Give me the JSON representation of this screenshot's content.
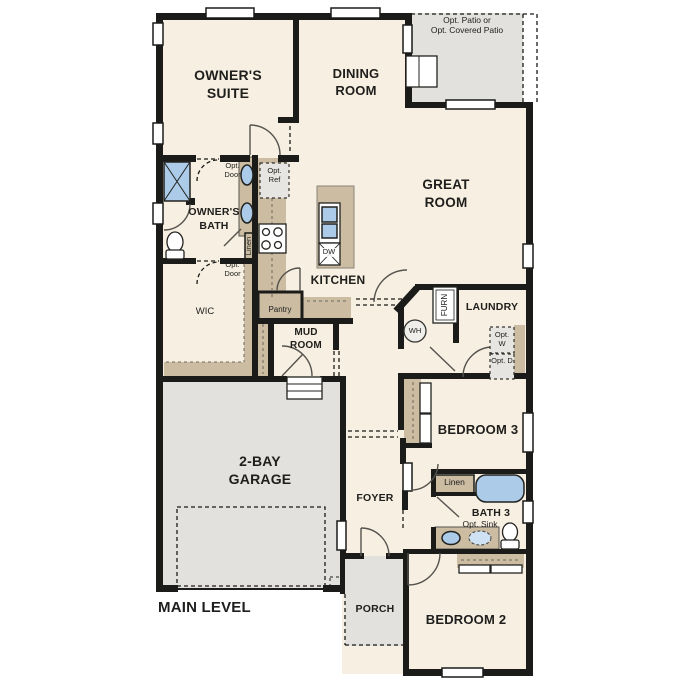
{
  "plan": {
    "title": "MAIN LEVEL",
    "rooms": {
      "owners_suite": "OWNER'S SUITE",
      "dining_room": "DINING ROOM",
      "great_room": "GREAT ROOM",
      "owners_bath": "OWNER'S BATH",
      "wic": "WIC",
      "kitchen": "KITCHEN",
      "pantry": "Pantry",
      "mud_room": "MUD ROOM",
      "laundry": "LAUNDRY",
      "garage": "2-BAY GARAGE",
      "foyer": "FOYER",
      "porch": "PORCH",
      "bedroom3": "BEDROOM 3",
      "bath3": "BATH 3",
      "bedroom2": "BEDROOM 2"
    },
    "annotations": {
      "patio_line1": "Opt. Patio or",
      "patio_line2": "Opt. Covered Patio",
      "opt_door": "Opt. Door",
      "opt_ref": "Opt. Ref",
      "opt_w": "Opt. W",
      "opt_d": "Opt. D",
      "opt_sink": "Opt. Sink",
      "linen": "Linen",
      "furn": "FURN",
      "wh": "WH",
      "dw": "DW"
    },
    "colors": {
      "floor": "#f7efe1",
      "wall": "#1b1b19",
      "casework": "#cbbca2",
      "exterior": "#e2e1dd",
      "fixture_blue": "#abcbe8",
      "window_white": "#ffffff"
    }
  }
}
